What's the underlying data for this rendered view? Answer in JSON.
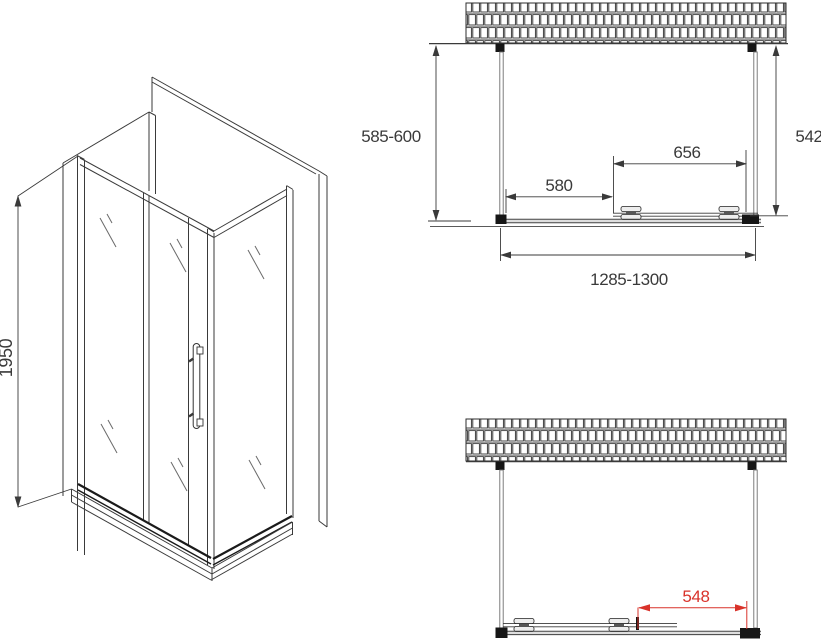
{
  "drawing": {
    "type": "shower-enclosure-technical-drawing",
    "labels": {
      "iso_height": "1950",
      "top_depth": "585-600",
      "top_glass_height": "542",
      "top_door_width": "656",
      "top_fixed_width": "580",
      "top_total_width": "1285-1300",
      "bottom_opening_width": "548"
    },
    "colors": {
      "line": "#3a3a3a",
      "bracket": "#161616",
      "dimension_red": "#d9322a",
      "hatch_mortar": "#9a9a9a"
    }
  }
}
